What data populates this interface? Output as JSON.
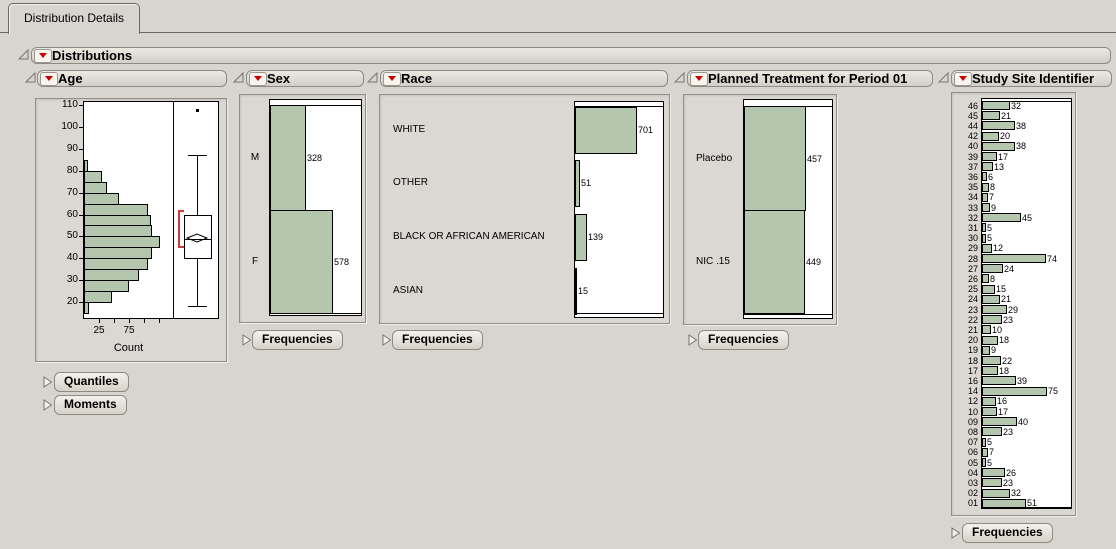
{
  "tab": {
    "label": "Distribution Details"
  },
  "outline_title": "Distributions",
  "colors": {
    "bar_fill": "#b5c6af",
    "red_triangle": "#cc0000",
    "bracket_red": "#cc3b36"
  },
  "panels": {
    "age": {
      "title": "Age",
      "section_buttons": [
        "Quantiles",
        "Moments"
      ],
      "chart_data": {
        "type": "histogram+boxplot",
        "xlabel": "Count",
        "y_ticks": [
          20,
          30,
          40,
          50,
          60,
          70,
          80,
          90,
          100,
          110
        ],
        "x_ticks": [
          25,
          50,
          75,
          100,
          125
        ],
        "x_tick_labels": [
          25,
          75
        ],
        "bin_start": 15,
        "bin_width": 5,
        "bin_counts": [
          8,
          47,
          75,
          91,
          107,
          113,
          127,
          113,
          112,
          107,
          59,
          38,
          30,
          7
        ],
        "boxplot": {
          "whisker_low": 18,
          "q1": 40,
          "median": 49,
          "mean": 50.5,
          "q3": 60,
          "whisker_high": 87,
          "outlier": 108,
          "shortest_half_low": 45,
          "shortest_half_high": 62
        }
      }
    },
    "sex": {
      "title": "Sex",
      "section_buttons": [
        "Frequencies"
      ],
      "chart_data": {
        "type": "bar",
        "categories": [
          "M",
          "F"
        ],
        "values": [
          328,
          578
        ]
      }
    },
    "race": {
      "title": "Race",
      "section_buttons": [
        "Frequencies"
      ],
      "chart_data": {
        "type": "bar",
        "categories": [
          "WHITE",
          "OTHER",
          "BLACK OR AFRICAN AMERICAN",
          "ASIAN"
        ],
        "values": [
          701,
          51,
          139,
          15
        ]
      }
    },
    "treatment": {
      "title": "Planned Treatment for Period 01",
      "section_buttons": [
        "Frequencies"
      ],
      "chart_data": {
        "type": "bar",
        "categories": [
          "Placebo",
          "NIC .15"
        ],
        "values": [
          457,
          449
        ]
      }
    },
    "site": {
      "title": "Study Site Identifier",
      "section_buttons": [
        "Frequencies"
      ],
      "chart_data": {
        "type": "bar",
        "categories": [
          "46",
          "45",
          "44",
          "42",
          "40",
          "39",
          "37",
          "36",
          "35",
          "34",
          "33",
          "32",
          "31",
          "30",
          "29",
          "28",
          "27",
          "26",
          "25",
          "24",
          "23",
          "22",
          "21",
          "20",
          "19",
          "18",
          "17",
          "16",
          "14",
          "12",
          "10",
          "09",
          "08",
          "07",
          "06",
          "05",
          "04",
          "03",
          "02",
          "01"
        ],
        "values": [
          32,
          21,
          38,
          20,
          38,
          17,
          13,
          6,
          8,
          7,
          9,
          45,
          5,
          5,
          12,
          74,
          24,
          8,
          15,
          21,
          29,
          23,
          10,
          18,
          9,
          22,
          18,
          39,
          75,
          16,
          17,
          40,
          23,
          5,
          7,
          5,
          26,
          23,
          32,
          51
        ]
      }
    }
  }
}
